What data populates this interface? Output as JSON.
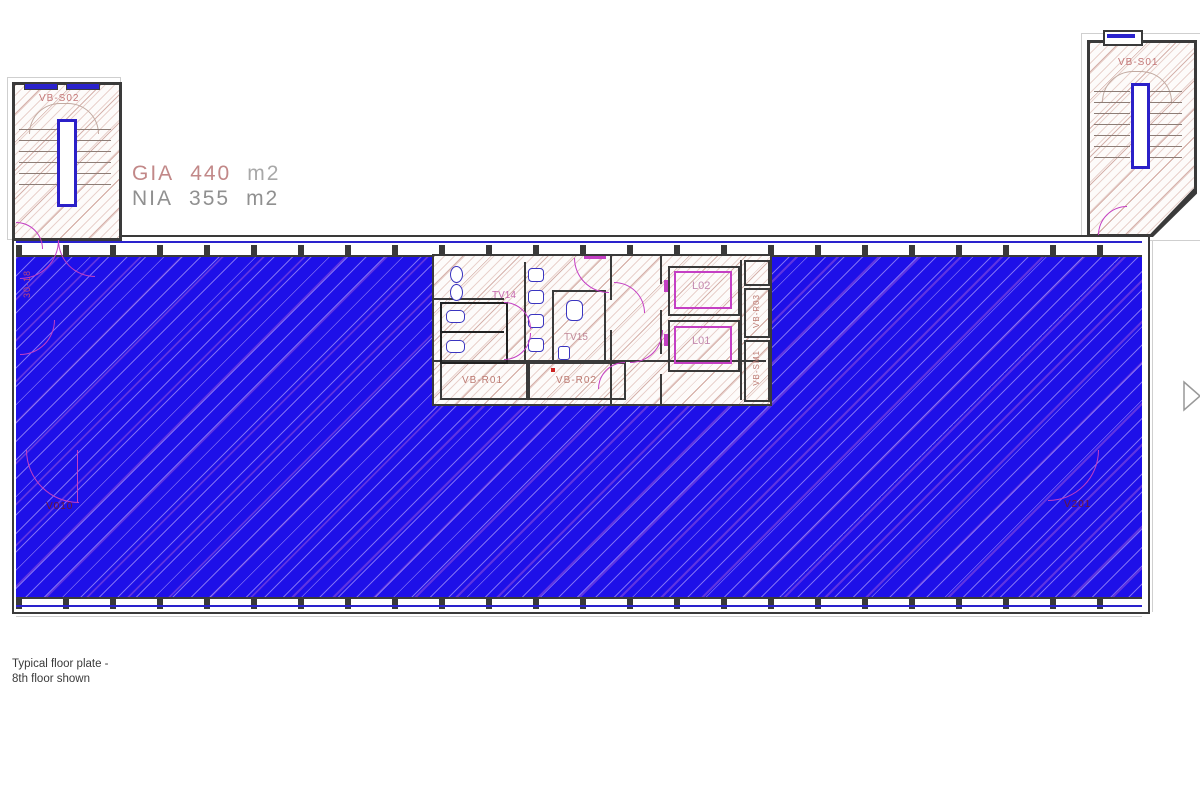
{
  "drawing": {
    "area_stats": {
      "gia_label": "GIA",
      "gia_value": "440",
      "gia_unit": "m2",
      "nia_label": "NIA",
      "nia_value": "355",
      "nia_unit": "m2"
    },
    "caption_line1": "Typical floor plate -",
    "caption_line2": "8th floor shown",
    "rooms": {
      "stair_left": "VB-S02",
      "stair_right": "VB-S01",
      "toilet_male": "TV14",
      "toilet_accessible": "TV15",
      "plant_room_1": "VB-R01",
      "plant_room_2": "VB-R02",
      "riser_1": "VB-R03",
      "riser_2": "VB-SM1",
      "lift_1": "L01",
      "lift_2": "L02"
    },
    "door_tags": {
      "bottom_left": "V010",
      "bottom_right": "V201",
      "left_wall": "30-18"
    },
    "colors": {
      "nia_highlight": "#1e10e8",
      "core_hatch": "#d9b5ab",
      "wall": "#3a3a3a",
      "door_magenta": "#c43fc4",
      "fixture_blue": "#3a35c0",
      "label_red": "#bc7a72",
      "stat_red": "#c28888",
      "stat_gray": "#909090"
    }
  }
}
